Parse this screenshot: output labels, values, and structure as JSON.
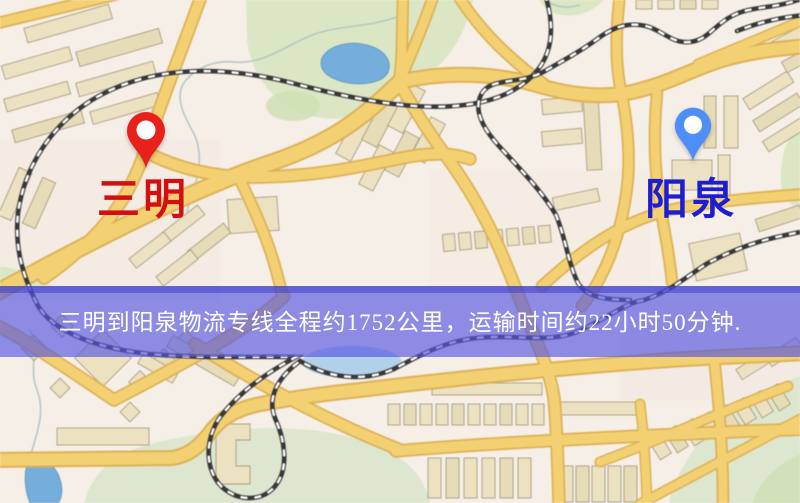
{
  "page": {
    "width": 800,
    "height": 503,
    "kind": "static route map"
  },
  "map": {
    "markers": {
      "origin": {
        "label": "三明",
        "pin_color": "#e8211a",
        "label_color": "#d40f0f",
        "pin_style": "red-map-pin"
      },
      "destination": {
        "label": "阳泉",
        "pin_color": "#4f8ef7",
        "label_color": "#1e1ecf",
        "pin_style": "blue-map-pin"
      }
    },
    "banner": {
      "text": "三明到阳泉物流专线全程约1752公里，运输时间约22小时50分钟.",
      "origin": "三明",
      "destination": "阳泉",
      "distance": "约1752公里",
      "duration": "约22小时50分钟",
      "background_color": "#5656de",
      "text_color": "#ffffff"
    },
    "legend_colors": {
      "road": "#f3d173",
      "building": "#ece2c2",
      "park": "#dbe7c4",
      "water": "#76aedb",
      "railway": "#383838"
    }
  }
}
